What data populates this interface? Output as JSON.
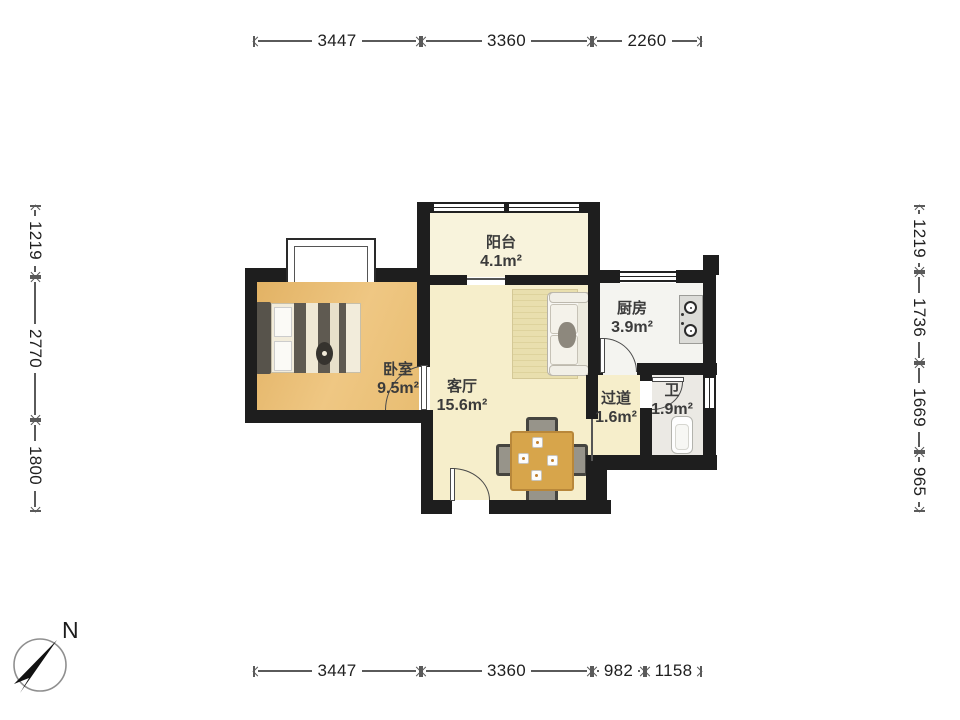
{
  "compass": {
    "label": "N"
  },
  "dimensions": {
    "top": [
      "3447",
      "3360",
      "2260"
    ],
    "bottom": [
      "3447",
      "3360",
      "982",
      "1158"
    ],
    "left": [
      "1219",
      "2770",
      "1800"
    ],
    "right": [
      "1219",
      "1736",
      "1669",
      "965"
    ]
  },
  "rooms": {
    "balcony": {
      "name": "阳台",
      "area": "4.1m²"
    },
    "bedroom": {
      "name": "卧室",
      "area": "9.5m²"
    },
    "living": {
      "name": "客厅",
      "area": "15.6m²"
    },
    "kitchen": {
      "name": "厨房",
      "area": "3.9m²"
    },
    "hallway": {
      "name": "过道",
      "area": "1.6m²"
    },
    "bath": {
      "name": "卫",
      "area": "1.9m²"
    }
  },
  "colors": {
    "wall": "#1e1e1e",
    "bedroom_floor": "#e9c078",
    "living_floor": "#f6eecb",
    "balcony_floor": "#f8f3dc",
    "kitchen_floor": "#f4f4f0",
    "bath_floor": "#ebe9e4",
    "table": "#d7a54b",
    "dimension_line": "#5a5a5a"
  }
}
